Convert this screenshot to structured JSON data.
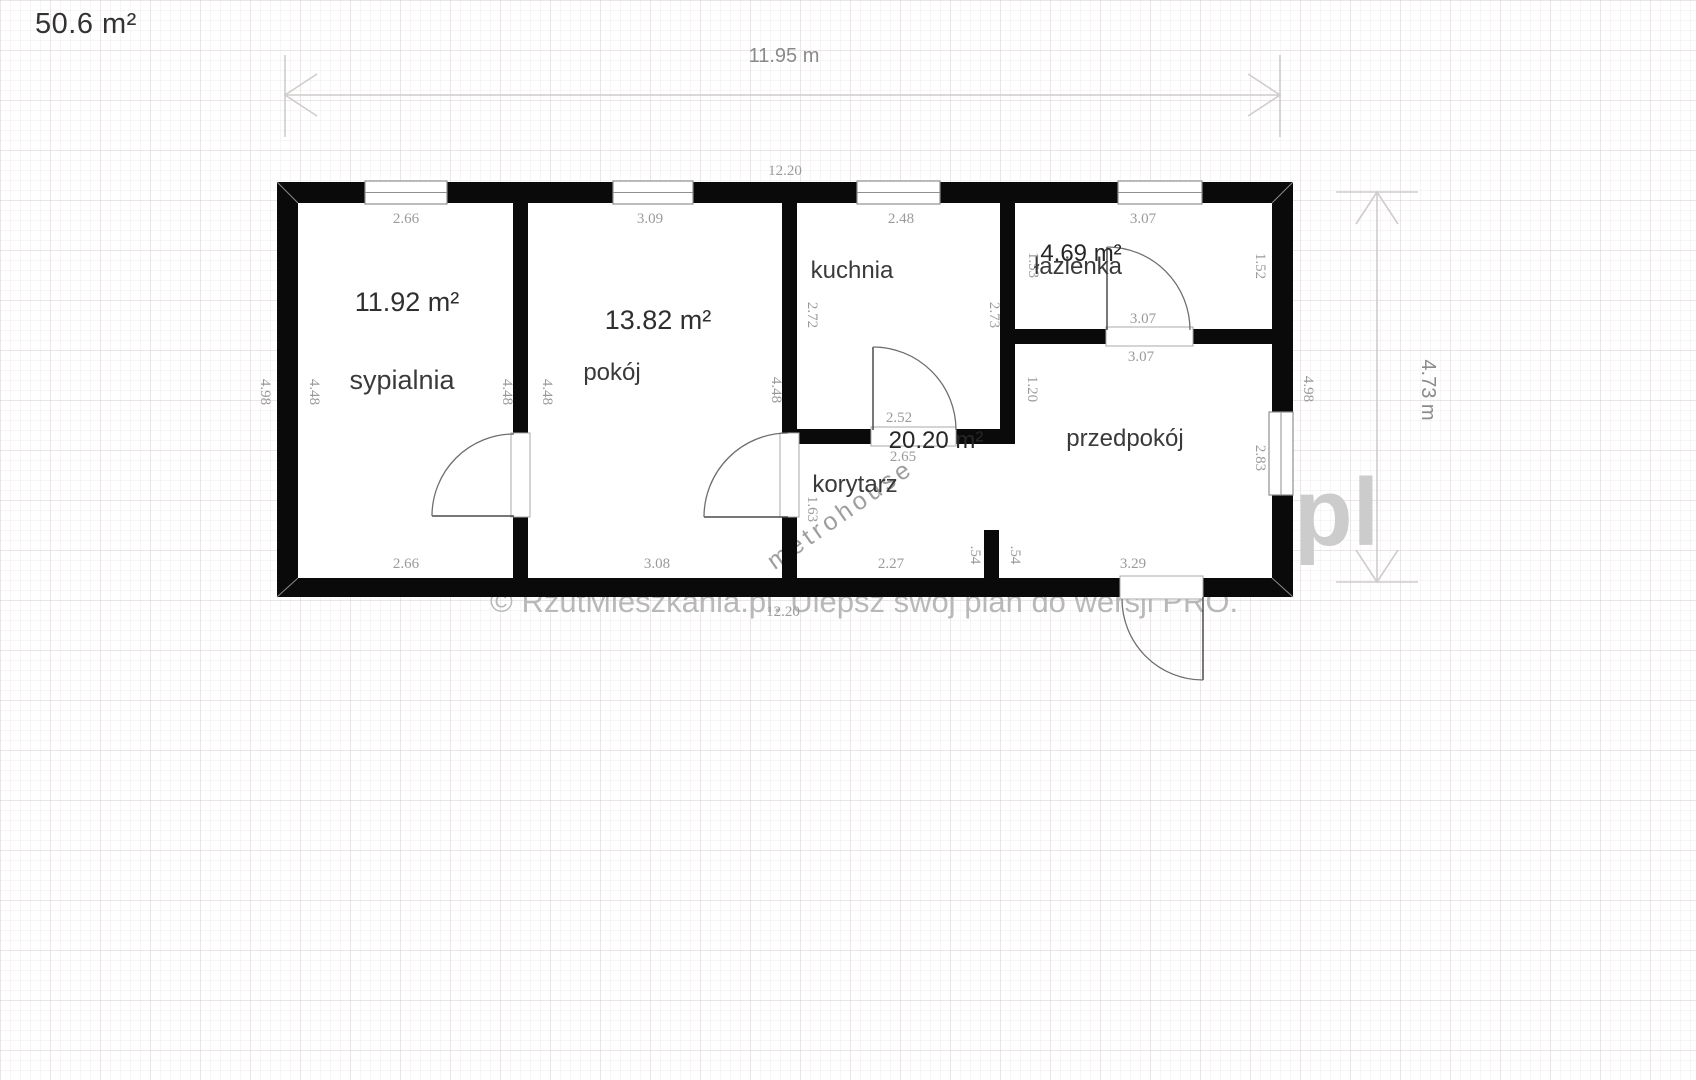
{
  "header": {
    "total_area": "50.6 m²"
  },
  "watermarks": {
    "line": "© RzutMieszkania.pl. Ulepsz swój plan do wersji PRO.",
    "diagonal": "metrohouse",
    "corner": "pl"
  },
  "plan": {
    "overall": {
      "outer_width": "11.95 m",
      "outer_height": "4.73 m",
      "inner_width": "12.20"
    },
    "rooms": [
      {
        "name": "sypialnia",
        "area": "11.92 m²",
        "dims": {
          "top": "2.66",
          "bottom": "2.66",
          "left": "4.48",
          "right": "4.48"
        }
      },
      {
        "name": "pokój",
        "area": "13.82 m²",
        "dims": {
          "top": "3.09",
          "bottom": "3.08",
          "left": "4.48",
          "right": "4.48"
        }
      },
      {
        "name": "kuchnia",
        "area": "",
        "dims": {
          "top": "2.48",
          "left": "2.72",
          "right": "2.73"
        }
      },
      {
        "name": "łazienka",
        "area": "4.69 m²",
        "dims": {
          "top": "3.07",
          "bottom": "3.07",
          "left": "1.53",
          "right": "1.52"
        }
      },
      {
        "name": "korytarz",
        "area": "20.20 m²",
        "dims": {
          "top": "2.52",
          "mid": "2.65",
          "bottom": "2.27",
          "side": "1.63"
        }
      },
      {
        "name": "przedpokój",
        "area": "",
        "dims": {
          "top": "3.07",
          "bottom": "3.29",
          "left": "1.20",
          "window": "2.83"
        }
      }
    ],
    "side_dims": {
      "outer_left": "4.98",
      "outer_right": "4.98",
      "stub_left": ".54",
      "stub_right": ".54"
    },
    "labels": [
      {
        "t": "11.95 m",
        "x": 784,
        "y": 62,
        "cls": "bigdim",
        "name": "dim-overall-width"
      },
      {
        "t": "4.73 m",
        "x": 1422,
        "y": 390,
        "cls": "bigdim",
        "r": 1,
        "name": "dim-overall-height"
      },
      {
        "t": "12.20",
        "x": 785,
        "y": 175,
        "cls": "dim",
        "name": "dim-inner-width-top"
      },
      {
        "t": "12.20",
        "x": 783,
        "y": 616,
        "cls": "dim",
        "name": "dim-inner-width-bottom"
      },
      {
        "t": "2.66",
        "x": 406,
        "y": 223,
        "cls": "dim",
        "name": "dim-sypialnia-top"
      },
      {
        "t": "3.09",
        "x": 650,
        "y": 223,
        "cls": "dim",
        "name": "dim-pokoj-top"
      },
      {
        "t": "2.48",
        "x": 901,
        "y": 223,
        "cls": "dim",
        "name": "dim-kuchnia-top"
      },
      {
        "t": "3.07",
        "x": 1143,
        "y": 223,
        "cls": "dim",
        "name": "dim-lazienka-top"
      },
      {
        "t": "4.98",
        "x": 261,
        "y": 392,
        "cls": "dim",
        "r": 1,
        "name": "dim-outer-left"
      },
      {
        "t": "4.48",
        "x": 310,
        "y": 392,
        "cls": "dim",
        "r": 1,
        "name": "dim-sypialnia-left"
      },
      {
        "t": "4.48",
        "x": 503,
        "y": 392,
        "cls": "dim",
        "r": 1,
        "name": "dim-sypialnia-right"
      },
      {
        "t": "4.48",
        "x": 543,
        "y": 392,
        "cls": "dim",
        "r": 1,
        "name": "dim-pokoj-left"
      },
      {
        "t": "4.48",
        "x": 772,
        "y": 390,
        "cls": "dim",
        "r": 1,
        "name": "dim-pokoj-right"
      },
      {
        "t": "2.72",
        "x": 808,
        "y": 315,
        "cls": "dim",
        "r": 1,
        "name": "dim-kuchnia-left"
      },
      {
        "t": "2.73",
        "x": 990,
        "y": 315,
        "cls": "dim",
        "r": 1,
        "name": "dim-kuchnia-right"
      },
      {
        "t": "1.53",
        "x": 1029,
        "y": 265,
        "cls": "dim",
        "r": 1,
        "name": "dim-lazienka-left"
      },
      {
        "t": "1.52",
        "x": 1256,
        "y": 266,
        "cls": "dim",
        "r": 1,
        "name": "dim-lazienka-right"
      },
      {
        "t": "3.07",
        "x": 1143,
        "y": 323,
        "cls": "dim",
        "name": "dim-lazienka-bottom"
      },
      {
        "t": "3.07",
        "x": 1141,
        "y": 361,
        "cls": "dim",
        "name": "dim-przedpokoj-top"
      },
      {
        "t": "1.20",
        "x": 1028,
        "y": 389,
        "cls": "dim",
        "r": 1,
        "name": "dim-wall-stub-120"
      },
      {
        "t": "2.83",
        "x": 1256,
        "y": 458,
        "cls": "dim",
        "r": 1,
        "name": "dim-przedpokoj-window"
      },
      {
        "t": "4.98",
        "x": 1304,
        "y": 389,
        "cls": "dim",
        "r": 1,
        "name": "dim-outer-right"
      },
      {
        "t": "2.52",
        "x": 899,
        "y": 422,
        "cls": "dim",
        "name": "dim-korytarz-top"
      },
      {
        "t": "2.65",
        "x": 903,
        "y": 461,
        "cls": "dim",
        "name": "dim-korytarz-mid"
      },
      {
        "t": "1.63",
        "x": 808,
        "y": 509,
        "cls": "dim",
        "r": 1,
        "name": "dim-korytarz-side"
      },
      {
        "t": "2.66",
        "x": 406,
        "y": 568,
        "cls": "dim",
        "name": "dim-sypialnia-bottom"
      },
      {
        "t": "3.08",
        "x": 657,
        "y": 568,
        "cls": "dim",
        "name": "dim-pokoj-bottom"
      },
      {
        "t": "2.27",
        "x": 891,
        "y": 568,
        "cls": "dim",
        "name": "dim-korytarz-bottom"
      },
      {
        "t": ".54",
        "x": 971,
        "y": 555,
        "cls": "dim",
        "r": 1,
        "name": "dim-stub-left"
      },
      {
        "t": ".54",
        "x": 1011,
        "y": 555,
        "cls": "dim",
        "r": 1,
        "name": "dim-stub-right"
      },
      {
        "t": "3.29",
        "x": 1133,
        "y": 568,
        "cls": "dim",
        "name": "dim-przedpokoj-bottom"
      },
      {
        "t": "11.92 m²",
        "x": 407,
        "y": 311,
        "cls": "area",
        "name": "area-label-sypialnia"
      },
      {
        "t": "sypialnia",
        "x": 402,
        "y": 389,
        "cls": "room-lg",
        "name": "room-label-sypialnia"
      },
      {
        "t": "13.82 m²",
        "x": 658,
        "y": 329,
        "cls": "area",
        "name": "area-label-pokoj"
      },
      {
        "t": "pokój",
        "x": 612,
        "y": 380,
        "cls": "room",
        "name": "room-label-pokoj"
      },
      {
        "t": "kuchnia",
        "x": 852,
        "y": 278,
        "cls": "room",
        "name": "room-label-kuchnia"
      },
      {
        "t": "4.69 m²",
        "x": 1081,
        "y": 261,
        "cls": "area-sm",
        "name": "area-label-lazienka"
      },
      {
        "t": "łazienka",
        "x": 1078,
        "y": 274,
        "cls": "room",
        "name": "room-label-lazienka"
      },
      {
        "t": "20.20 m²",
        "x": 936,
        "y": 448,
        "cls": "area-sm",
        "name": "area-label-korytarz"
      },
      {
        "t": "korytarz",
        "x": 855,
        "y": 492,
        "cls": "room",
        "name": "room-label-korytarz"
      },
      {
        "t": "przedpokój",
        "x": 1125,
        "y": 446,
        "cls": "room",
        "name": "room-label-przedpokoj"
      }
    ]
  }
}
